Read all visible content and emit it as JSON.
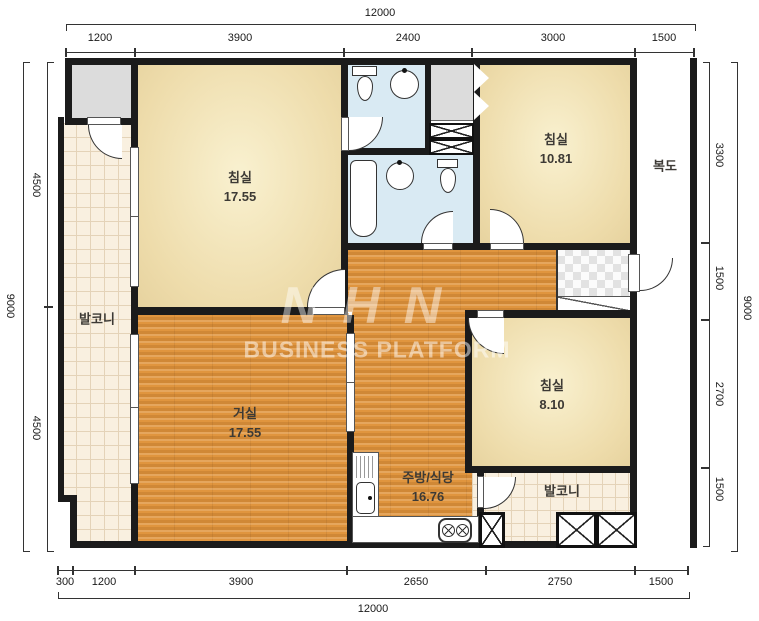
{
  "watermark": {
    "logo": "NHN",
    "subtitle": "BUSINESS PLATFORM"
  },
  "rooms": [
    {
      "id": "bedroom-master",
      "label": "침실",
      "area": "17.55"
    },
    {
      "id": "bedroom-2",
      "label": "침실",
      "area": "10.81"
    },
    {
      "id": "bedroom-3",
      "label": "침실",
      "area": "8.10"
    },
    {
      "id": "living-room",
      "label": "거실",
      "area": "17.55"
    },
    {
      "id": "kitchen-dining",
      "label": "주방/식당",
      "area": "16.76"
    },
    {
      "id": "balcony-left",
      "label": "발코니",
      "area": ""
    },
    {
      "id": "balcony-right",
      "label": "발코니",
      "area": ""
    },
    {
      "id": "corridor",
      "label": "복도",
      "area": ""
    }
  ],
  "dims": {
    "top": {
      "total": "12000",
      "segments": [
        "1200",
        "3900",
        "2400",
        "3000",
        "1500"
      ]
    },
    "bottom": {
      "total": "12000",
      "segments": [
        "300",
        "1200",
        "3900",
        "2650",
        "2750",
        "1500"
      ]
    },
    "left": {
      "total": "9000",
      "segments": [
        "4500",
        "4500"
      ]
    },
    "right": {
      "total": "9000",
      "segments": [
        "3300",
        "1500",
        "2700",
        "1500"
      ]
    }
  },
  "colors": {
    "wall": "#1b1b1b",
    "bedroom_fill": "#eedcab",
    "wood_fill": "#e0953e",
    "bath_fill": "#d9eaf3",
    "tile_fill": "#f9f0e0",
    "closet_fill": "#dcdcdc"
  }
}
